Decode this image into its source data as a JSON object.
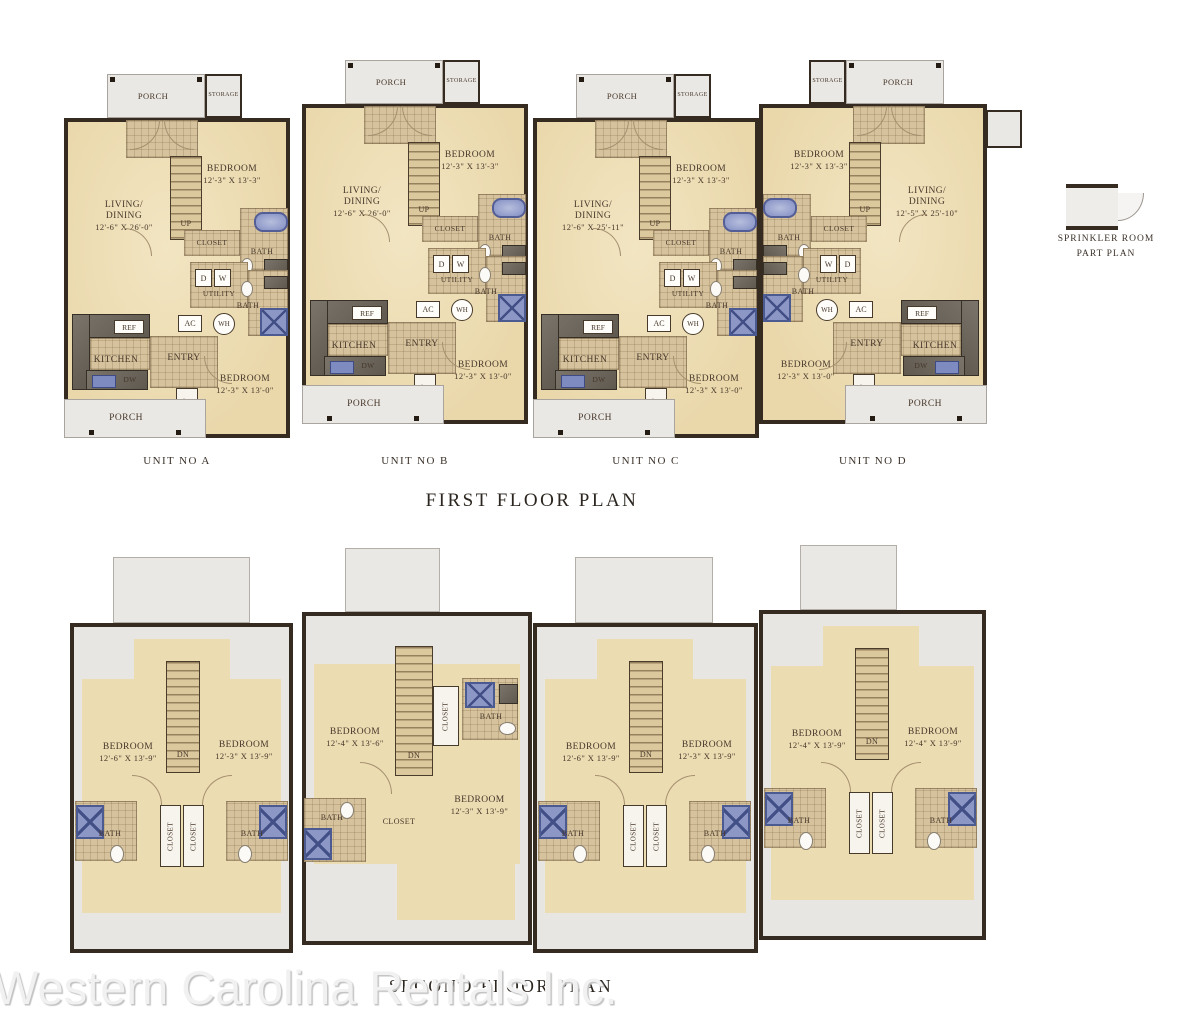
{
  "watermark": "Western Carolina Rentals Inc.",
  "sprinkler": {
    "line1": "SPRINKLER ROOM",
    "line2": "PART PLAN"
  },
  "first_floor": {
    "title": "FIRST FLOOR PLAN",
    "units": [
      {
        "label": "UNIT NO A",
        "porch_top": "PORCH",
        "storage": "STORAGE",
        "up": "UP",
        "bedroom1_name": "BEDROOM",
        "bedroom1_dim": "12'-3\" X 13'-3\"",
        "living_1": "LIVING/",
        "living_2": "DINING",
        "living_dim": "12'-6\" X 26'-0\"",
        "closet1": "CLOSET",
        "bath1": "BATH",
        "d": "D",
        "w": "W",
        "utility": "UTILITY",
        "bath2": "BATH",
        "ac": "AC",
        "wh": "WH",
        "ref": "REF",
        "kitchen": "KITCHEN",
        "entry": "ENTRY",
        "dw": "DW",
        "bedroom2_name": "BEDROOM",
        "bedroom2_dim": "12'-3\" X 13'-0\"",
        "closet2": "CLOSET",
        "porch_bottom": "PORCH"
      },
      {
        "label": "UNIT NO B",
        "porch_top": "PORCH",
        "storage": "STORAGE",
        "up": "UP",
        "bedroom1_name": "BEDROOM",
        "bedroom1_dim": "12'-3\" X 13'-3\"",
        "living_1": "LIVING/",
        "living_2": "DINING",
        "living_dim": "12'-6\" X 26'-0\"",
        "closet1": "CLOSET",
        "bath1": "BATH",
        "d": "D",
        "w": "W",
        "utility": "UTILITY",
        "bath2": "BATH",
        "ac": "AC",
        "wh": "WH",
        "ref": "REF",
        "kitchen": "KITCHEN",
        "entry": "ENTRY",
        "dw": "DW",
        "bedroom2_name": "BEDROOM",
        "bedroom2_dim": "12'-3\" X 13'-0\"",
        "closet2": "CLOSET",
        "porch_bottom": "PORCH"
      },
      {
        "label": "UNIT NO C",
        "porch_top": "PORCH",
        "storage": "STORAGE",
        "up": "UP",
        "bedroom1_name": "BEDROOM",
        "bedroom1_dim": "12'-3\" X 13'-3\"",
        "living_1": "LIVING/",
        "living_2": "DINING",
        "living_dim": "12'-6\" X 25'-11\"",
        "closet1": "CLOSET",
        "bath1": "BATH",
        "d": "D",
        "w": "W",
        "utility": "UTILITY",
        "bath2": "BATH",
        "ac": "AC",
        "wh": "WH",
        "ref": "REF",
        "kitchen": "KITCHEN",
        "entry": "ENTRY",
        "dw": "DW",
        "bedroom2_name": "BEDROOM",
        "bedroom2_dim": "12'-3\" X 13'-0\"",
        "closet2": "CLOSET",
        "porch_bottom": "PORCH"
      },
      {
        "label": "UNIT NO D",
        "porch_top": "PORCH",
        "storage": "STORAGE",
        "up": "UP",
        "bedroom1_name": "BEDROOM",
        "bedroom1_dim": "12'-3\" X 13'-3\"",
        "living_1": "LIVING/",
        "living_2": "DINING",
        "living_dim": "12'-5\" X 25'-10\"",
        "closet1": "CLOSET",
        "bath1": "BATH",
        "d": "D",
        "w": "W",
        "utility": "UTILITY",
        "bath2": "BATH",
        "ac": "AC",
        "wh": "WH",
        "ref": "REF",
        "kitchen": "KITCHEN",
        "entry": "ENTRY",
        "dw": "DW",
        "bedroom2_name": "BEDROOM",
        "bedroom2_dim": "12'-3\" X 13'-0\"",
        "closet2": "CLOSET",
        "porch_bottom": "PORCH"
      }
    ]
  },
  "second_floor": {
    "title": "SECOND FLOOR PLAN",
    "units": [
      {
        "bedL_name": "BEDROOM",
        "bedL_dim": "12'-6\" X 13'-9\"",
        "bedR_name": "BEDROOM",
        "bedR_dim": "12'-3\" X 13'-9\"",
        "dn": "DN",
        "closetL": "CLOSET",
        "closetR": "CLOSET",
        "bathL": "BATH",
        "bathR": "BATH"
      },
      {
        "bedL_name": "BEDROOM",
        "bedL_dim": "12'-4\" X 13'-6\"",
        "bedR_name": "BEDROOM",
        "bedR_dim": "12'-3\" X 13'-9\"",
        "dn": "DN",
        "closet_upper": "CLOSET",
        "closet_center": "CLOSET",
        "bath_upper": "BATH",
        "bathL": "BATH"
      },
      {
        "bedL_name": "BEDROOM",
        "bedL_dim": "12'-6\" X 13'-9\"",
        "bedR_name": "BEDROOM",
        "bedR_dim": "12'-3\" X 13'-9\"",
        "dn": "DN",
        "closetL": "CLOSET",
        "closetR": "CLOSET",
        "bathL": "BATH",
        "bathR": "BATH"
      },
      {
        "bedL_name": "BEDROOM",
        "bedL_dim": "12'-4\" X 13'-9\"",
        "bedR_name": "BEDROOM",
        "bedR_dim": "12'-4\" X 13'-9\"",
        "dn": "DN",
        "closetL": "CLOSET",
        "closetR": "CLOSET",
        "bathL": "BATH",
        "bathR": "BATH"
      }
    ]
  }
}
